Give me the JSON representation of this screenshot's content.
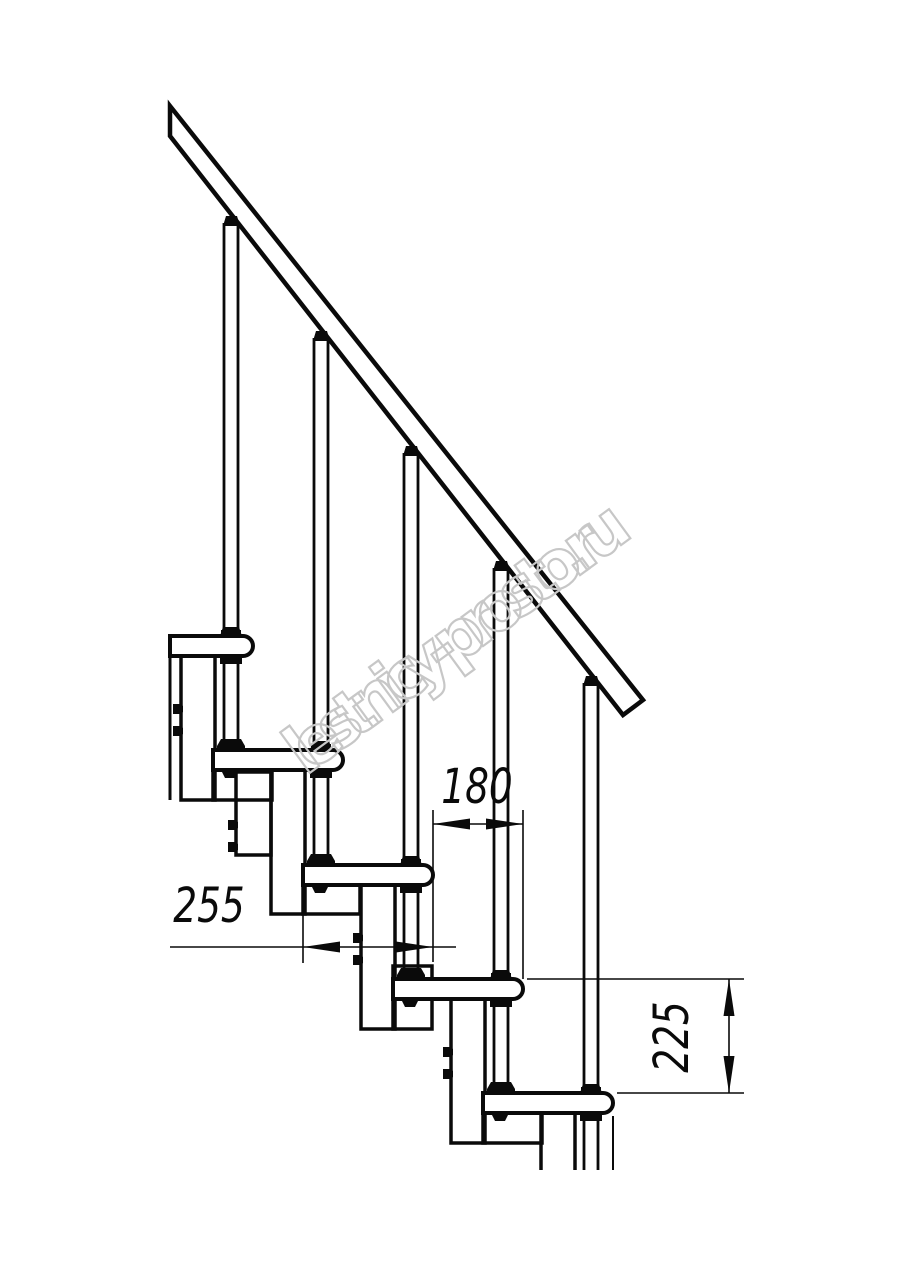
{
  "watermark": {
    "text": "lestnicy-prosto.ru",
    "color": "#c7c7c7",
    "angle_deg": -36.2,
    "center": [
      464,
      660
    ]
  },
  "dimensions": {
    "step_run": {
      "label": "180",
      "value_mm": 180,
      "line": [
        433,
        824,
        523,
        824
      ],
      "exts": [
        [
          433,
          810,
          433,
          962
        ],
        [
          523,
          810,
          523,
          979
        ]
      ],
      "arrows": [
        [
          "left",
          433,
          824
        ],
        [
          "right",
          523,
          824
        ]
      ],
      "label_pos": [
        477,
        803
      ],
      "rotate": 0
    },
    "tread_depth": {
      "label": "255",
      "value_mm": 255,
      "line": [
        170,
        947,
        456,
        947
      ],
      "exts": [
        [
          303,
          911,
          303,
          963
        ]
      ],
      "arrows": [
        [
          "left",
          303,
          947
        ],
        [
          "right",
          433,
          947
        ]
      ],
      "label_pos": [
        209,
        922
      ],
      "rotate": 0
    },
    "step_rise": {
      "label": "225",
      "value_mm": 225,
      "line": [
        729,
        979,
        729,
        1093
      ],
      "exts": [
        [
          527,
          979,
          744,
          979
        ],
        [
          617,
          1093,
          744,
          1093
        ]
      ],
      "arrows": [
        [
          "up",
          729,
          979
        ],
        [
          "down",
          729,
          1093
        ]
      ],
      "label_pos": [
        688,
        1037
      ],
      "rotate": -90
    }
  },
  "drawing": {
    "canvas": [
      914,
      1280
    ],
    "line_color": "#0a0a0a",
    "clip_left_x": 170,
    "bottom_cut_y": 1170,
    "rail_outline": [
      [
        170,
        106
      ],
      [
        643,
        700
      ],
      [
        623,
        715
      ],
      [
        170,
        136
      ]
    ],
    "rail_lower_edge": {
      "x0": 170,
      "y0": 136,
      "slope": 1.278
    },
    "tread": {
      "len": 130,
      "h": 20,
      "r": 10
    },
    "rod_dx": 108,
    "rod_half_gap": 7,
    "left_edge_line": [
      170,
      636,
      170,
      800
    ],
    "steps": [
      {
        "x": 123,
        "y": 636,
        "tread_clip": 170,
        "column": [
          181,
          656,
          34,
          144
        ],
        "connector": [
          213,
          769,
          59,
          31
        ],
        "bolts": [
          173,
          704,
          726
        ],
        "underclip": false
      },
      {
        "x": 213,
        "y": 750,
        "column": [
          271,
          770,
          34,
          144
        ],
        "connector": [
          303,
          883,
          57,
          31
        ],
        "clamp": [
          236,
          772,
          35,
          83
        ],
        "bolts": [
          228,
          820,
          842
        ],
        "underclip": true
      },
      {
        "x": 303,
        "y": 865,
        "column": [
          361,
          885,
          34,
          144
        ],
        "connector": [
          393,
          966,
          39,
          63
        ],
        "bolts": [
          353,
          933,
          955
        ],
        "underclip": true
      },
      {
        "x": 393,
        "y": 979,
        "column": [
          451,
          999,
          34,
          144
        ],
        "connector": [
          483,
          1112,
          59,
          31
        ],
        "bolts": [
          443,
          1047,
          1069
        ],
        "underclip": true
      },
      {
        "x": 483,
        "y": 1093,
        "column": [
          541,
          1113,
          34,
          57
        ],
        "open_bottom": true,
        "extra_lines": [
          [
            613,
            1116,
            613,
            1170
          ]
        ],
        "underclip": true
      }
    ]
  }
}
